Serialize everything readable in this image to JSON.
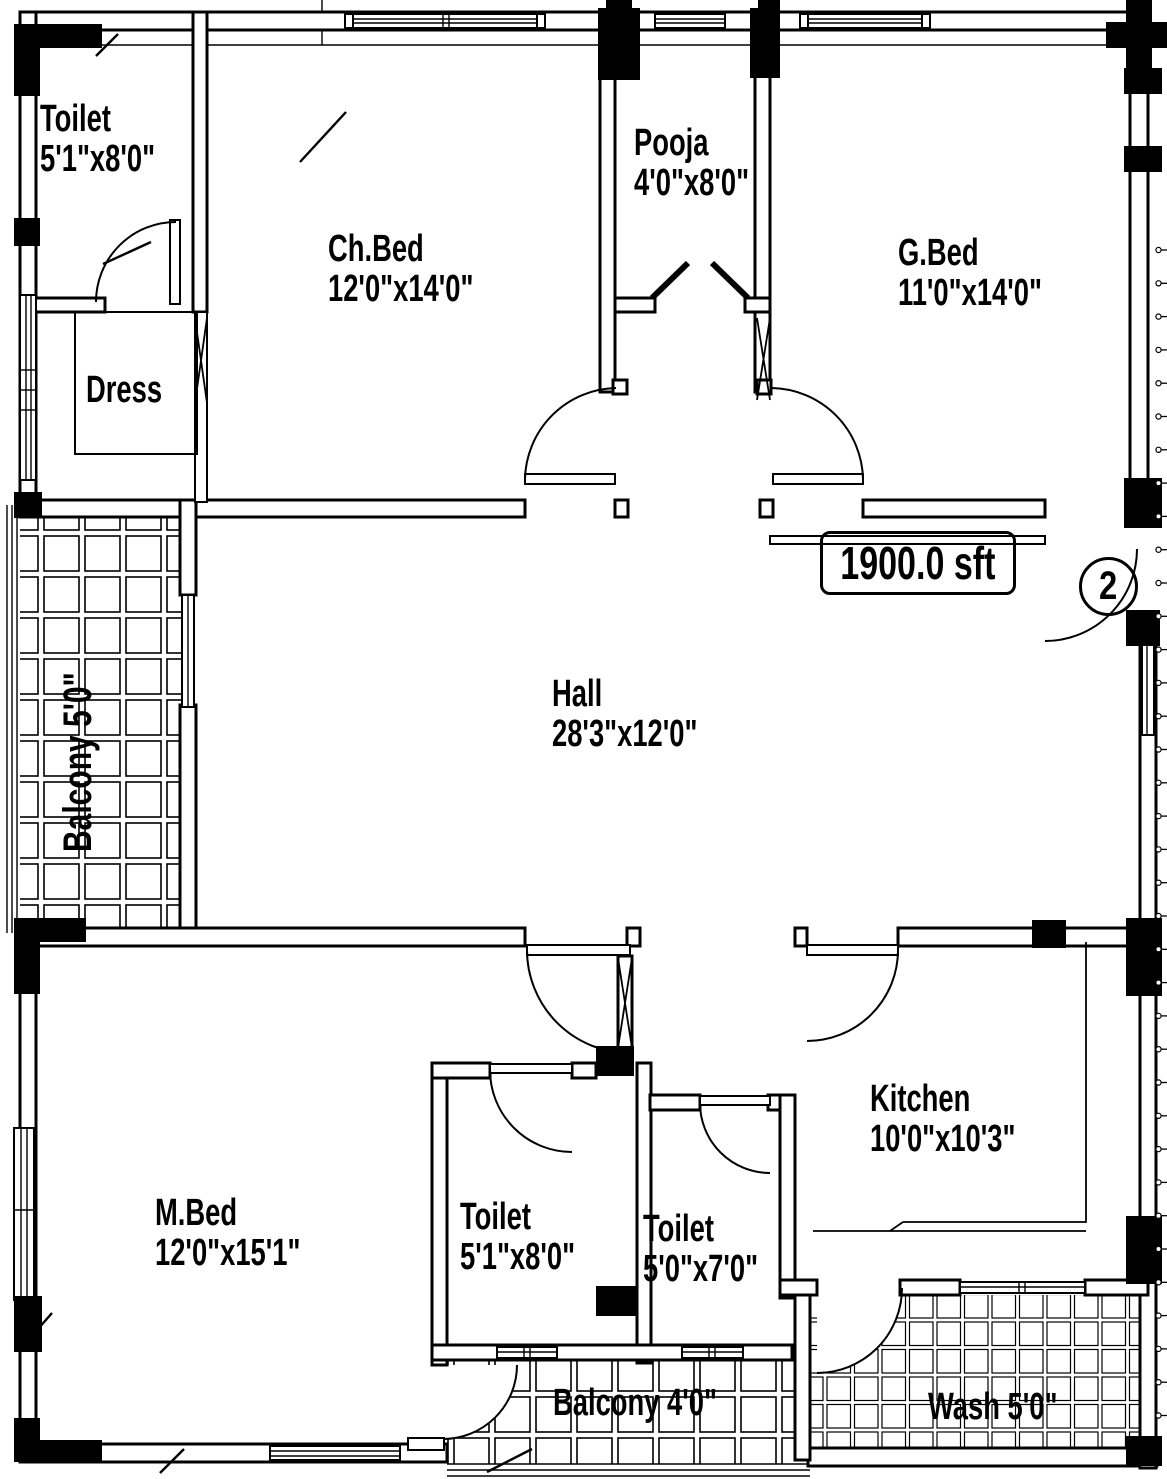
{
  "plan": {
    "area_label": "1900.0 sft",
    "unit_number": "2",
    "colors": {
      "ink": "#000000",
      "paper": "#ffffff"
    },
    "rooms": {
      "toilet_top": {
        "name": "Toilet",
        "dims": "5'1\"x8'0\""
      },
      "ch_bed": {
        "name": "Ch.Bed",
        "dims": "12'0\"x14'0\""
      },
      "pooja": {
        "name": "Pooja",
        "dims": "4'0\"x8'0\""
      },
      "g_bed": {
        "name": "G.Bed",
        "dims": "11'0\"x14'0\""
      },
      "dress": {
        "name": "Dress"
      },
      "balcony_left": {
        "name": "Balcony  5'0\""
      },
      "hall": {
        "name": "Hall",
        "dims": "28'3\"x12'0\""
      },
      "m_bed": {
        "name": "M.Bed",
        "dims": "12'0\"x15'1\""
      },
      "toilet_bottom_left": {
        "name": "Toilet",
        "dims": "5'1\"x8'0\""
      },
      "toilet_bottom_right": {
        "name": "Toilet",
        "dims": "5'0\"x7'0\""
      },
      "kitchen": {
        "name": "Kitchen",
        "dims": "10'0\"x10'3\""
      },
      "wash": {
        "name": "Wash 5'0\""
      },
      "balcony_bottom": {
        "name": "Balcony  4'0\""
      }
    }
  }
}
